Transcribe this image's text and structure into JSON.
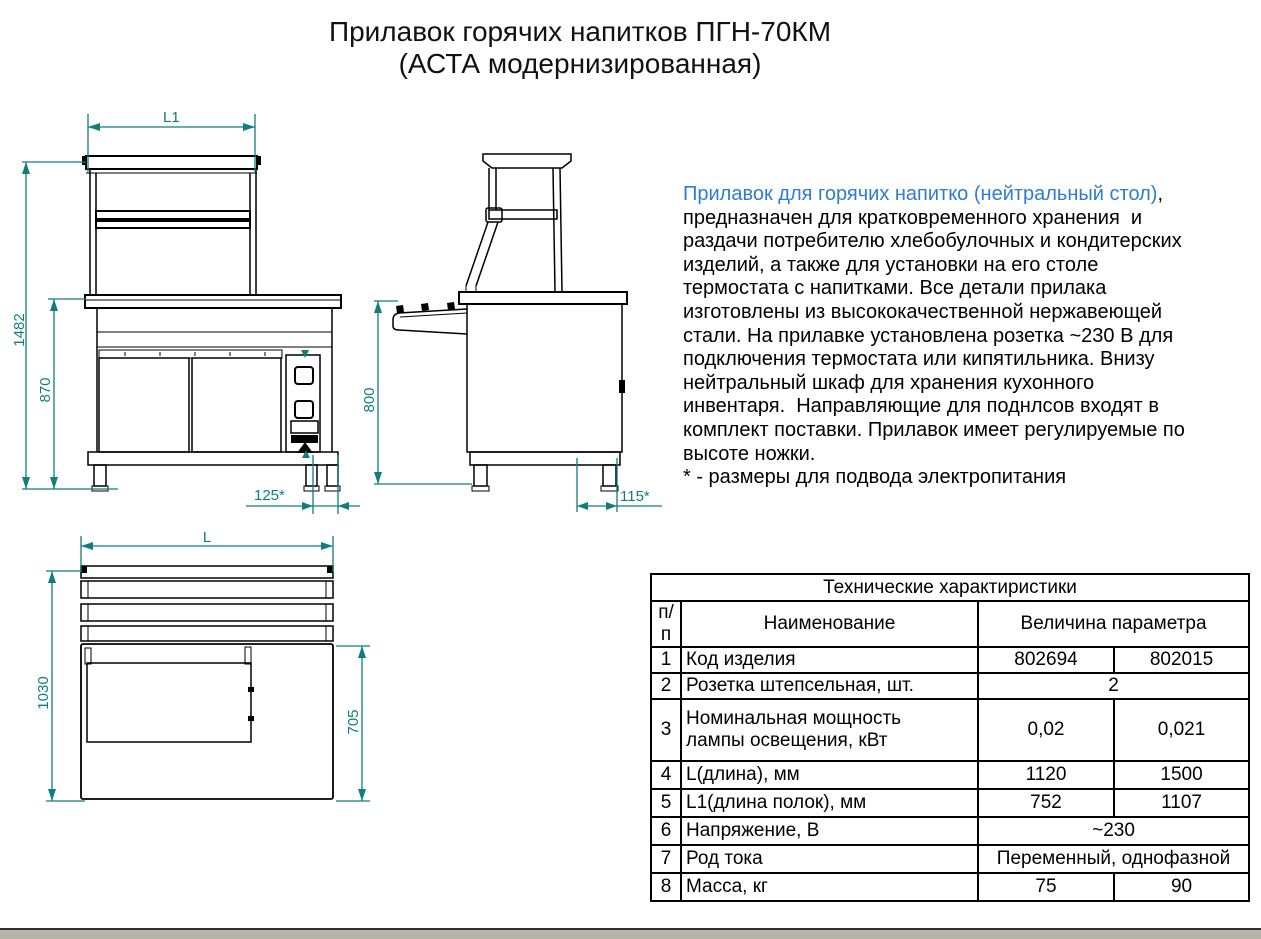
{
  "title": {
    "line1": "Прилавок горячих напитков ПГН-70КМ",
    "line2": "(АСТА модернизированная)"
  },
  "description": {
    "lead": "Прилавок для горячих напитко (нейтральный стол)",
    "body": ",\nпредназначен для кратковременного хранения  и\nраздачи потребителю хлебобулочных и кондитерских\nизделий, а также для установки на его столе\nтермостата с напитками. Все детали прилака\nизготовлены из высококачественной нержавеющей\nстали. На прилавке установлена розетка ~230 В для\nподключения термостата или кипятильника. Внизу\nнейтральный шкаф для хранения кухонного\nинвентаря.  Направляющие для поднлсов входят в\nкомплект поставки. Прилавок имеет регулируемые по\nвысоте ножки.",
    "note": "* - размеры для подвода электропитания",
    "lead_color": "#2e7cd4"
  },
  "drawings": {
    "dim_color": "#117d7d",
    "front_view": {
      "width_top": "L1",
      "height_total": "1482",
      "height_base": "870",
      "socket_offset": "125*"
    },
    "side_view": {
      "height_rail": "800",
      "socket_offset": "115*"
    },
    "plan_view": {
      "width": "L",
      "depth_total": "1030",
      "depth_inner": "705"
    }
  },
  "table": {
    "title": "Технические характиристики",
    "col_num": "п/п",
    "col_name": "Наименование",
    "col_value": "Величина параметра",
    "rows": [
      {
        "num": "1",
        "name": "Код изделия",
        "v1": "802694",
        "v2": "802015"
      },
      {
        "num": "2",
        "name": "Розетка штепсельная, шт.",
        "span": "2"
      },
      {
        "num": "3",
        "name": "Номинальная мощность\nлампы освещения, кВт",
        "v1": "0,02",
        "v2": "0,021"
      },
      {
        "num": "4",
        "name": "L(длина), мм",
        "v1": "1120",
        "v2": "1500"
      },
      {
        "num": "5",
        "name": "L1(длина полок), мм",
        "v1": "752",
        "v2": "1107"
      },
      {
        "num": "6",
        "name": "Напряжение, В",
        "span": "~230"
      },
      {
        "num": "7",
        "name": "Род тока",
        "span": "Переменный, однофазной"
      },
      {
        "num": "8",
        "name": "Масса, кг",
        "v1": "75",
        "v2": "90"
      }
    ]
  }
}
